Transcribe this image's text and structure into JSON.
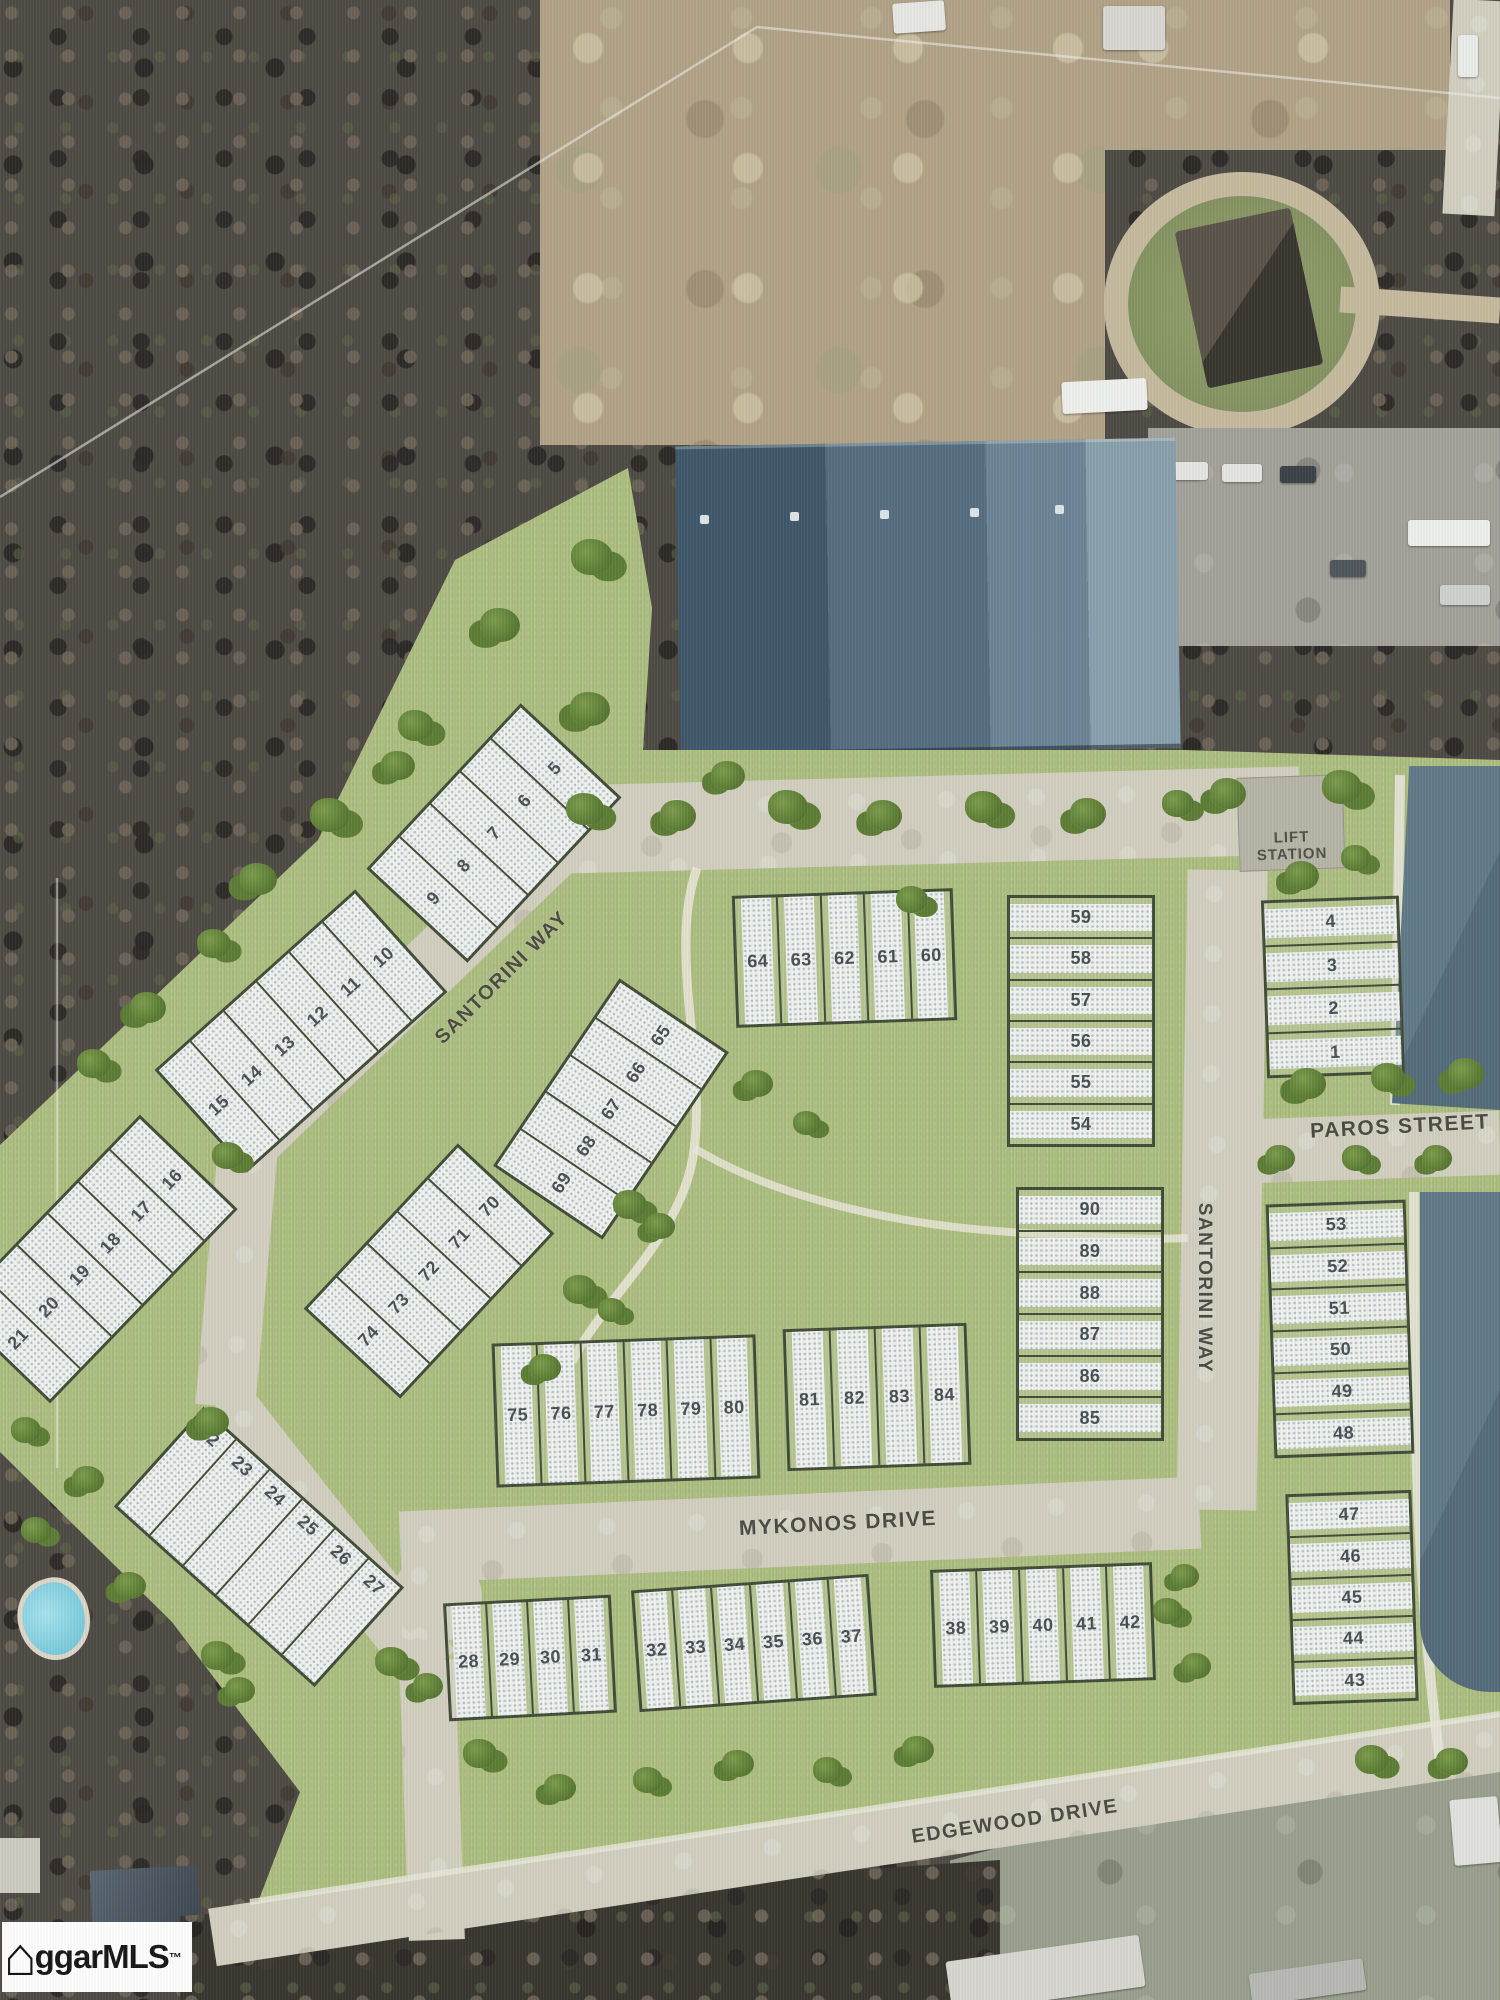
{
  "watermark": {
    "text": "ggarMLS",
    "tm": "™",
    "house_icon": "⌂"
  },
  "lift_station": {
    "line1": "LIFT",
    "line2": "STATION"
  },
  "streets": [
    {
      "id": "santorini-way-diagonal",
      "label": "SANTORINI WAY",
      "x": 502,
      "y": 978,
      "rot": -45,
      "size": 20
    },
    {
      "id": "paros-street",
      "label": "PAROS STREET",
      "x": 1400,
      "y": 1127,
      "rot": -3,
      "size": 21
    },
    {
      "id": "santorini-way-vertical",
      "label": "SANTORINI WAY",
      "x": 1204,
      "y": 1288,
      "rot": 90,
      "size": 19
    },
    {
      "id": "mykonos-drive",
      "label": "MYKONOS DRIVE",
      "x": 838,
      "y": 1524,
      "rot": -3,
      "size": 21
    },
    {
      "id": "edgewood-drive",
      "label": "EDGEWOOD DRIVE",
      "x": 1015,
      "y": 1822,
      "rot": -8.6,
      "size": 20
    }
  ],
  "lot_groups": [
    {
      "id": "5-9",
      "x": 491,
      "y": 830,
      "w": 220,
      "h": 132,
      "rot": -47,
      "cells": [
        "9",
        "8",
        "7",
        "6",
        "5"
      ]
    },
    {
      "id": "10-15",
      "x": 298,
      "y": 1028,
      "w": 264,
      "h": 132,
      "rot": -42,
      "cells": [
        "15",
        "14",
        "13",
        "12",
        "11",
        "10"
      ]
    },
    {
      "id": "16-21",
      "x": 92,
      "y": 1256,
      "w": 264,
      "h": 130,
      "rot": -46,
      "cells": [
        "21",
        "20",
        "19",
        "18",
        "17",
        "16"
      ]
    },
    {
      "id": "65-69",
      "x": 608,
      "y": 1106,
      "w": 220,
      "h": 126,
      "rot": -56,
      "cells": [
        "69",
        "68",
        "67",
        "66",
        "65"
      ]
    },
    {
      "id": "70-74",
      "x": 426,
      "y": 1268,
      "w": 220,
      "h": 126,
      "rot": -47,
      "cells": [
        "74",
        "73",
        "72",
        "71",
        "70"
      ]
    },
    {
      "id": "60-64",
      "x": 841,
      "y": 955,
      "w": 215,
      "h": 126,
      "rot": -2,
      "gap": true,
      "cells": [
        "64",
        "63",
        "62",
        "61",
        "60"
      ]
    },
    {
      "id": "54-59",
      "x": 1078,
      "y": 1018,
      "w": 142,
      "h": 246,
      "rot": 0,
      "dir": "col",
      "gap": true,
      "cells": [
        "59",
        "58",
        "57",
        "56",
        "55",
        "54"
      ]
    },
    {
      "id": "1-4",
      "x": 1330,
      "y": 984,
      "w": 132,
      "h": 172,
      "rot": -2,
      "dir": "col",
      "gap": true,
      "cells": [
        "4",
        "3",
        "2",
        "1"
      ]
    },
    {
      "id": "85-90",
      "x": 1087,
      "y": 1311,
      "w": 142,
      "h": 248,
      "rot": 0,
      "dir": "col",
      "gap": true,
      "cells": [
        "90",
        "89",
        "88",
        "87",
        "86",
        "85"
      ]
    },
    {
      "id": "48-53",
      "x": 1337,
      "y": 1326,
      "w": 134,
      "h": 248,
      "rot": -2,
      "dir": "col",
      "gap": true,
      "cells": [
        "53",
        "52",
        "51",
        "50",
        "49",
        "48"
      ]
    },
    {
      "id": "75-80",
      "x": 623,
      "y": 1408,
      "w": 258,
      "h": 138,
      "rot": -2,
      "gap": true,
      "cells": [
        "75",
        "76",
        "77",
        "78",
        "79",
        "80"
      ]
    },
    {
      "id": "81-84",
      "x": 874,
      "y": 1394,
      "w": 178,
      "h": 136,
      "rot": -2,
      "gap": true,
      "cells": [
        "81",
        "82",
        "83",
        "84"
      ]
    },
    {
      "id": "28-31",
      "x": 527,
      "y": 1655,
      "w": 162,
      "h": 112,
      "rot": -3,
      "gap": true,
      "cells": [
        "28",
        "29",
        "30",
        "31"
      ]
    },
    {
      "id": "32-37",
      "x": 751,
      "y": 1640,
      "w": 232,
      "h": 116,
      "rot": -4,
      "gap": true,
      "cells": [
        "32",
        "33",
        "34",
        "35",
        "36",
        "37"
      ]
    },
    {
      "id": "38-42",
      "x": 1040,
      "y": 1622,
      "w": 216,
      "h": 112,
      "rot": -2,
      "gap": true,
      "cells": [
        "38",
        "39",
        "40",
        "41",
        "42"
      ]
    },
    {
      "id": "22-27",
      "x": 256,
      "y": 1544,
      "w": 264,
      "h": 128,
      "rot": 42,
      "num_pos": "start",
      "cells": [
        "22",
        "23",
        "24",
        "25",
        "26",
        "27"
      ]
    },
    {
      "id": "43-47",
      "x": 1349,
      "y": 1594,
      "w": 120,
      "h": 205,
      "rot": -2,
      "dir": "col",
      "gap": true,
      "cells": [
        "47",
        "46",
        "45",
        "44",
        "43"
      ]
    }
  ],
  "trees": [
    [
      500,
      628,
      40
    ],
    [
      592,
      560,
      42
    ],
    [
      590,
      712,
      40
    ],
    [
      416,
      728,
      36
    ],
    [
      398,
      768,
      34
    ],
    [
      330,
      818,
      40
    ],
    [
      258,
      882,
      38
    ],
    [
      214,
      946,
      34
    ],
    [
      148,
      1010,
      36
    ],
    [
      94,
      1066,
      34
    ],
    [
      728,
      778,
      34
    ],
    [
      585,
      812,
      38
    ],
    [
      678,
      818,
      36
    ],
    [
      788,
      810,
      40
    ],
    [
      884,
      818,
      36
    ],
    [
      984,
      810,
      38
    ],
    [
      1088,
      816,
      36
    ],
    [
      1178,
      806,
      32
    ],
    [
      1228,
      796,
      36
    ],
    [
      1342,
      790,
      40
    ],
    [
      1302,
      878,
      34
    ],
    [
      1356,
      860,
      30
    ],
    [
      1308,
      1086,
      36
    ],
    [
      1388,
      1080,
      34
    ],
    [
      1466,
      1076,
      36
    ],
    [
      912,
      902,
      32
    ],
    [
      1280,
      1160,
      30
    ],
    [
      1357,
      1160,
      30
    ],
    [
      1437,
      1160,
      30
    ],
    [
      630,
      1207,
      34
    ],
    [
      660,
      1228,
      30
    ],
    [
      580,
      1292,
      34
    ],
    [
      545,
      1370,
      32
    ],
    [
      612,
      1312,
      28
    ],
    [
      757,
      1086,
      32
    ],
    [
      807,
      1125,
      28
    ],
    [
      1185,
      1578,
      28
    ],
    [
      1168,
      1613,
      30
    ],
    [
      1196,
      1668,
      30
    ],
    [
      228,
      1158,
      32
    ],
    [
      212,
      1424,
      34
    ],
    [
      26,
      1432,
      30
    ],
    [
      88,
      1482,
      32
    ],
    [
      36,
      1532,
      30
    ],
    [
      130,
      1588,
      32
    ],
    [
      218,
      1658,
      34
    ],
    [
      240,
      1692,
      30
    ],
    [
      392,
      1664,
      34
    ],
    [
      428,
      1688,
      30
    ],
    [
      480,
      1756,
      34
    ],
    [
      560,
      1790,
      32
    ],
    [
      648,
      1782,
      30
    ],
    [
      738,
      1766,
      32
    ],
    [
      828,
      1772,
      30
    ],
    [
      918,
      1752,
      32
    ],
    [
      1372,
      1762,
      34
    ],
    [
      1452,
      1764,
      32
    ]
  ],
  "colors": {
    "site_green": "#b0c183",
    "road": "#d3d0c1",
    "pond": "#5c7585",
    "lot_fill": "#f1f3ef",
    "lot_border": "#414c38",
    "label": "#4a4a42",
    "tree": "#5d7d35"
  }
}
